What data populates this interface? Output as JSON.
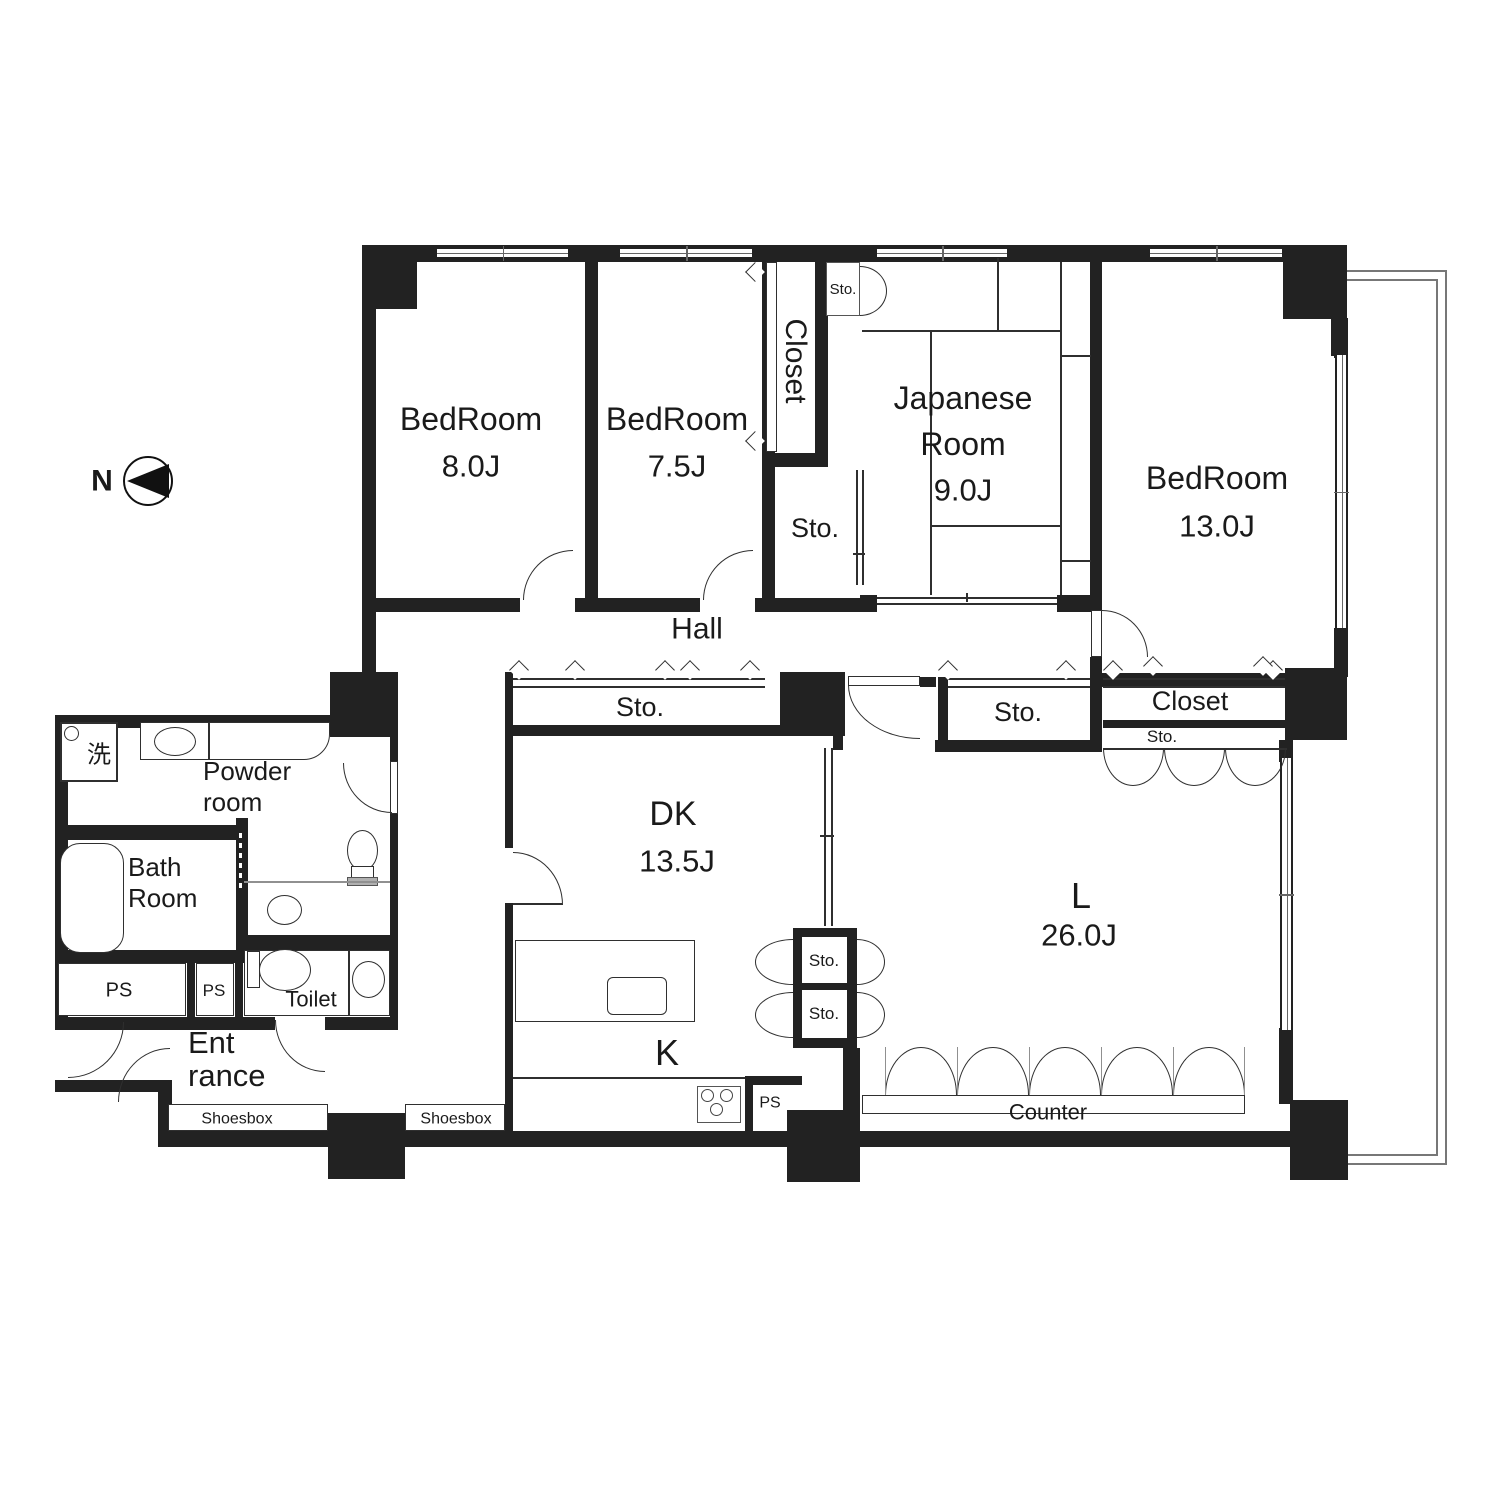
{
  "north": {
    "label": "N"
  },
  "rooms": {
    "bedroom1": {
      "name": "BedRoom",
      "size": "8.0J"
    },
    "bedroom2": {
      "name": "BedRoom",
      "size": "7.5J"
    },
    "bedroom3": {
      "name": "BedRoom",
      "size": "13.0J"
    },
    "japanese_room": {
      "line1": "Japanese",
      "line2": "Room",
      "size": "9.0J"
    },
    "living": {
      "name": "L",
      "size": "26.0J"
    },
    "dining_kitchen": {
      "name": "DK",
      "size": "13.5J"
    },
    "kitchen": {
      "name": "K"
    },
    "hall": {
      "name": "Hall"
    },
    "powder_room": {
      "line1": "Powder",
      "line2": "room"
    },
    "bath_room": {
      "line1": "Bath",
      "line2": "Room"
    },
    "toilet": {
      "name": "Toilet"
    },
    "entrance": {
      "line1": "Ent",
      "line2": "rance"
    }
  },
  "storage": {
    "closet_bedroom2": "Closet",
    "closet_bedroom3": "Closet",
    "sto_small_jp": "Sto.",
    "sto_square": "Sto.",
    "sto_dk": "Sto.",
    "sto_hall": "Sto.",
    "sto_closet_strip": "Sto.",
    "sto_k_upper": "Sto.",
    "sto_k_lower": "Sto.",
    "shoesbox_left": "Shoesbox",
    "shoesbox_right": "Shoesbox"
  },
  "utilities": {
    "ps_left": "PS",
    "ps_center": "PS",
    "ps_kitchen": "PS"
  },
  "fixtures": {
    "washing_machine": "洗"
  },
  "furniture": {
    "counter": "Counter"
  },
  "colors": {
    "wall": "#222222",
    "line": "#2f2f2f",
    "gray_line": "#909090",
    "balcony_line": "#777777"
  }
}
